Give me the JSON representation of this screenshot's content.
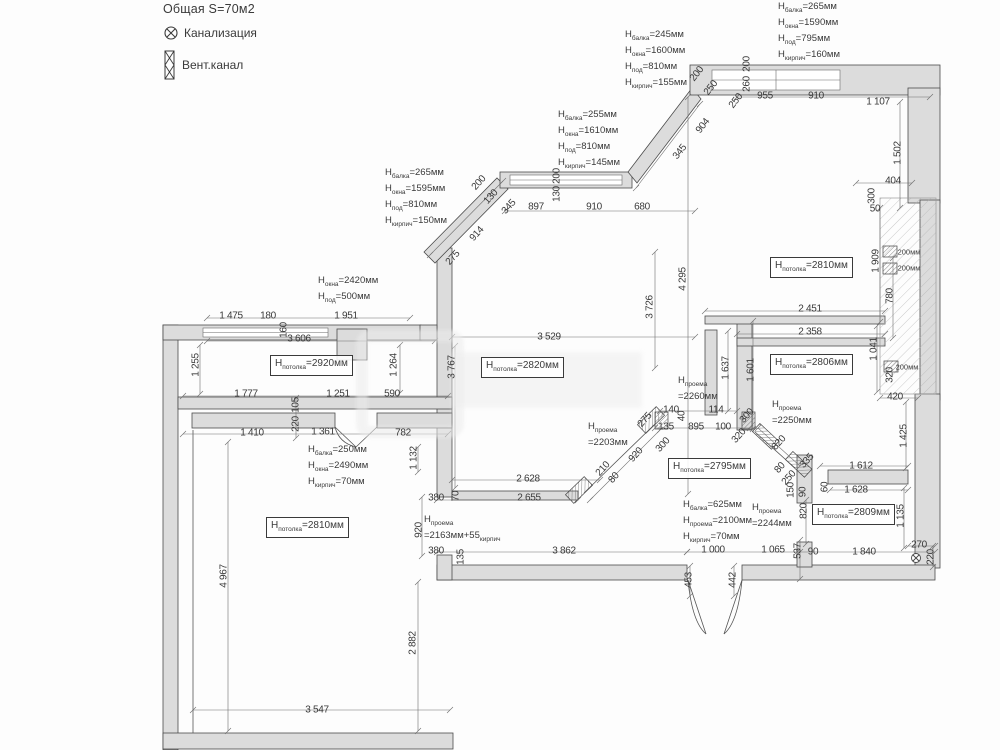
{
  "legend": {
    "area": "Общая S=70м2",
    "sewer": "Канализация",
    "vent": "Вент.канал"
  },
  "colors": {
    "wall_fill": "#dcdcdc",
    "wall_line": "#4b4b4b",
    "dim_text": "#3a3a3a"
  },
  "height_blocks": [
    {
      "x": 625,
      "y": 28,
      "lines": [
        {
          "sub": "балка",
          "val": "=245мм"
        },
        {
          "sub": "окна",
          "val": "=1600мм"
        },
        {
          "sub": "под",
          "val": "=810мм"
        },
        {
          "sub": "кирпич",
          "val": "=155мм"
        }
      ]
    },
    {
      "x": 778,
      "y": 0,
      "lines": [
        {
          "sub": "балка",
          "val": "=265мм"
        },
        {
          "sub": "окна",
          "val": "=1590мм"
        },
        {
          "sub": "под",
          "val": "=795мм"
        },
        {
          "sub": "кирпич",
          "val": "=160мм"
        }
      ]
    },
    {
      "x": 558,
      "y": 108,
      "lines": [
        {
          "sub": "балка",
          "val": "=255мм"
        },
        {
          "sub": "окна",
          "val": "=1610мм"
        },
        {
          "sub": "под",
          "val": "=810мм"
        },
        {
          "sub": "кирпич",
          "val": "=145мм"
        }
      ]
    },
    {
      "x": 385,
      "y": 166,
      "lines": [
        {
          "sub": "балка",
          "val": "=265мм"
        },
        {
          "sub": "окна",
          "val": "=1595мм"
        },
        {
          "sub": "под",
          "val": "=810мм"
        },
        {
          "sub": "кирпич",
          "val": "=150мм"
        }
      ]
    },
    {
      "x": 318,
      "y": 274,
      "lines": [
        {
          "sub": "окна",
          "val": "=2420мм"
        },
        {
          "sub": "под",
          "val": "=500мм"
        }
      ]
    },
    {
      "x": 308,
      "y": 443,
      "lines": [
        {
          "sub": "балка",
          "val": "=250мм"
        },
        {
          "sub": "окна",
          "val": "=2490мм"
        },
        {
          "sub": "кирпич",
          "val": "=70мм"
        }
      ]
    },
    {
      "x": 683,
      "y": 498,
      "lines": [
        {
          "sub": "балка",
          "val": "=625мм"
        },
        {
          "sub": "проема",
          "val": "=2100мм"
        },
        {
          "sub": "кирпич",
          "val": "=70мм"
        }
      ]
    },
    {
      "x": 752,
      "y": 501,
      "stacked": true,
      "lines": [
        {
          "sub": "проема",
          "val": "=2244мм"
        }
      ]
    },
    {
      "x": 588,
      "y": 420,
      "stacked": true,
      "lines": [
        {
          "sub": "проема",
          "val": "=2203мм"
        }
      ]
    },
    {
      "x": 424,
      "y": 513,
      "stacked": true,
      "lines": [
        {
          "sub": "проема",
          "val": "=2163мм+55",
          "suffix_sub": "кирпич"
        }
      ]
    },
    {
      "x": 678,
      "y": 374,
      "stacked": true,
      "lines": [
        {
          "sub": "проема",
          "val": "=2260мм"
        }
      ]
    },
    {
      "x": 772,
      "y": 398,
      "stacked": true,
      "lines": [
        {
          "sub": "проема",
          "val": "=2250мм"
        }
      ]
    }
  ],
  "room_labels": [
    {
      "x": 270,
      "y": 355,
      "sub": "потолка",
      "val": "=2920мм"
    },
    {
      "x": 481,
      "y": 357,
      "sub": "потолка",
      "val": "=2820мм"
    },
    {
      "x": 770,
      "y": 257,
      "sub": "потолка",
      "val": "=2810мм"
    },
    {
      "x": 770,
      "y": 354,
      "sub": "потолка",
      "val": "=2806мм"
    },
    {
      "x": 668,
      "y": 458,
      "sub": "потолка",
      "val": "=2795мм"
    },
    {
      "x": 812,
      "y": 504,
      "sub": "потолка",
      "val": "=2809мм"
    },
    {
      "x": 266,
      "y": 517,
      "sub": "потолка",
      "val": "=2810мм"
    }
  ],
  "dims": [
    {
      "t": "200",
      "x": 697,
      "y": 74,
      "r": -52
    },
    {
      "t": "250",
      "x": 711,
      "y": 88,
      "r": -52
    },
    {
      "t": "250",
      "x": 736,
      "y": 101,
      "r": -52
    },
    {
      "t": "955",
      "x": 765,
      "y": 96
    },
    {
      "t": "910",
      "x": 816,
      "y": 96
    },
    {
      "t": "1 107",
      "x": 878,
      "y": 102
    },
    {
      "t": "200",
      "x": 747,
      "y": 64,
      "r": -90
    },
    {
      "t": "260",
      "x": 747,
      "y": 84,
      "r": -90
    },
    {
      "t": "904",
      "x": 703,
      "y": 126,
      "r": -52
    },
    {
      "t": "345",
      "x": 680,
      "y": 152,
      "r": -52
    },
    {
      "t": "1 502",
      "x": 898,
      "y": 153,
      "r": -90
    },
    {
      "t": "404",
      "x": 893,
      "y": 181
    },
    {
      "t": "300",
      "x": 872,
      "y": 196,
      "r": -90
    },
    {
      "t": "50",
      "x": 875,
      "y": 209
    },
    {
      "t": "200мм",
      "x": 909,
      "y": 252,
      "small": true
    },
    {
      "t": "200мм",
      "x": 909,
      "y": 268,
      "small": true
    },
    {
      "t": "200мм",
      "x": 907,
      "y": 367,
      "small": true
    },
    {
      "t": "1 909",
      "x": 876,
      "y": 261,
      "r": -90
    },
    {
      "t": "780",
      "x": 890,
      "y": 296,
      "r": -90
    },
    {
      "t": "2 451",
      "x": 810,
      "y": 309
    },
    {
      "t": "2 358",
      "x": 810,
      "y": 332
    },
    {
      "t": "1 041",
      "x": 874,
      "y": 349,
      "r": -90
    },
    {
      "t": "320",
      "x": 890,
      "y": 375,
      "r": -90
    },
    {
      "t": "420",
      "x": 895,
      "y": 397
    },
    {
      "t": "1 425",
      "x": 904,
      "y": 436,
      "r": -90
    },
    {
      "t": "200",
      "x": 479,
      "y": 183,
      "r": -48
    },
    {
      "t": "130",
      "x": 491,
      "y": 197,
      "r": -48
    },
    {
      "t": "345",
      "x": 509,
      "y": 207,
      "r": -48
    },
    {
      "t": "200",
      "x": 557,
      "y": 176,
      "r": -90
    },
    {
      "t": "130",
      "x": 557,
      "y": 194,
      "r": -90
    },
    {
      "t": "914",
      "x": 477,
      "y": 234,
      "r": -48
    },
    {
      "t": "275",
      "x": 453,
      "y": 258,
      "r": -48
    },
    {
      "t": "897",
      "x": 536,
      "y": 207
    },
    {
      "t": "910",
      "x": 594,
      "y": 207
    },
    {
      "t": "680",
      "x": 642,
      "y": 207
    },
    {
      "t": "1 475",
      "x": 231,
      "y": 316
    },
    {
      "t": "180",
      "x": 268,
      "y": 316
    },
    {
      "t": "1 951",
      "x": 346,
      "y": 316
    },
    {
      "t": "160",
      "x": 284,
      "y": 330,
      "r": -90
    },
    {
      "t": "3 606",
      "x": 299,
      "y": 339
    },
    {
      "t": "1 255",
      "x": 196,
      "y": 365,
      "r": -90
    },
    {
      "t": "1 264",
      "x": 394,
      "y": 365,
      "r": -90
    },
    {
      "t": "1 777",
      "x": 246,
      "y": 394
    },
    {
      "t": "1 251",
      "x": 338,
      "y": 394
    },
    {
      "t": "590",
      "x": 392,
      "y": 394
    },
    {
      "t": "105",
      "x": 296,
      "y": 405,
      "r": -90
    },
    {
      "t": "220",
      "x": 296,
      "y": 424,
      "r": -90
    },
    {
      "t": "3 767",
      "x": 452,
      "y": 367,
      "r": -90
    },
    {
      "t": "3 529",
      "x": 549,
      "y": 337
    },
    {
      "t": "3 726",
      "x": 650,
      "y": 307,
      "r": -90
    },
    {
      "t": "4 295",
      "x": 683,
      "y": 279,
      "r": -90
    },
    {
      "t": "1 410",
      "x": 252,
      "y": 433
    },
    {
      "t": "1 361",
      "x": 323,
      "y": 432
    },
    {
      "t": "782",
      "x": 403,
      "y": 433
    },
    {
      "t": "1 132",
      "x": 414,
      "y": 458,
      "r": -90
    },
    {
      "t": "4 967",
      "x": 224,
      "y": 576,
      "r": -90
    },
    {
      "t": "2 882",
      "x": 413,
      "y": 643,
      "r": -90
    },
    {
      "t": "3 547",
      "x": 317,
      "y": 710
    },
    {
      "t": "920",
      "x": 419,
      "y": 530,
      "r": -90
    },
    {
      "t": "380",
      "x": 436,
      "y": 498
    },
    {
      "t": "70",
      "x": 456,
      "y": 496,
      "r": -90
    },
    {
      "t": "2 628",
      "x": 528,
      "y": 479
    },
    {
      "t": "2 655",
      "x": 529,
      "y": 498
    },
    {
      "t": "380",
      "x": 436,
      "y": 551
    },
    {
      "t": "135",
      "x": 461,
      "y": 557,
      "r": -90
    },
    {
      "t": "3 862",
      "x": 564,
      "y": 551
    },
    {
      "t": "210",
      "x": 603,
      "y": 469,
      "r": -48
    },
    {
      "t": "80",
      "x": 614,
      "y": 478,
      "r": -48
    },
    {
      "t": "920",
      "x": 636,
      "y": 455,
      "r": -48
    },
    {
      "t": "300",
      "x": 663,
      "y": 445,
      "r": -48
    },
    {
      "t": "140",
      "x": 671,
      "y": 410
    },
    {
      "t": "40",
      "x": 682,
      "y": 416,
      "r": -90
    },
    {
      "t": "114",
      "x": 716,
      "y": 410
    },
    {
      "t": "275",
      "x": 645,
      "y": 420,
      "r": -48
    },
    {
      "t": "135",
      "x": 666,
      "y": 427
    },
    {
      "t": "895",
      "x": 696,
      "y": 427
    },
    {
      "t": "100",
      "x": 723,
      "y": 427
    },
    {
      "t": "300",
      "x": 747,
      "y": 416,
      "r": -48
    },
    {
      "t": "320",
      "x": 739,
      "y": 436,
      "r": -48
    },
    {
      "t": "1 637",
      "x": 726,
      "y": 368,
      "r": -90
    },
    {
      "t": "1 601",
      "x": 751,
      "y": 370,
      "r": -90
    },
    {
      "t": "820",
      "x": 779,
      "y": 443,
      "r": -48
    },
    {
      "t": "335",
      "x": 807,
      "y": 461,
      "r": -48
    },
    {
      "t": "80",
      "x": 780,
      "y": 468,
      "r": -48
    },
    {
      "t": "250",
      "x": 789,
      "y": 478,
      "r": -48
    },
    {
      "t": "150",
      "x": 791,
      "y": 490,
      "r": -90
    },
    {
      "t": "90",
      "x": 803,
      "y": 492,
      "r": -90
    },
    {
      "t": "60",
      "x": 825,
      "y": 487,
      "r": -90
    },
    {
      "t": "820",
      "x": 804,
      "y": 511,
      "r": -90
    },
    {
      "t": "1 612",
      "x": 861,
      "y": 466
    },
    {
      "t": "1 628",
      "x": 856,
      "y": 490
    },
    {
      "t": "1 135",
      "x": 901,
      "y": 516,
      "r": -90
    },
    {
      "t": "537",
      "x": 798,
      "y": 551,
      "r": -90
    },
    {
      "t": "90",
      "x": 813,
      "y": 552
    },
    {
      "t": "1 840",
      "x": 864,
      "y": 552
    },
    {
      "t": "270",
      "x": 919,
      "y": 545
    },
    {
      "t": "220",
      "x": 931,
      "y": 557,
      "r": -90
    },
    {
      "t": "1 000",
      "x": 713,
      "y": 550
    },
    {
      "t": "1 065",
      "x": 773,
      "y": 550
    },
    {
      "t": "453",
      "x": 689,
      "y": 580,
      "r": -90
    },
    {
      "t": "442",
      "x": 733,
      "y": 580,
      "r": -90
    }
  ]
}
